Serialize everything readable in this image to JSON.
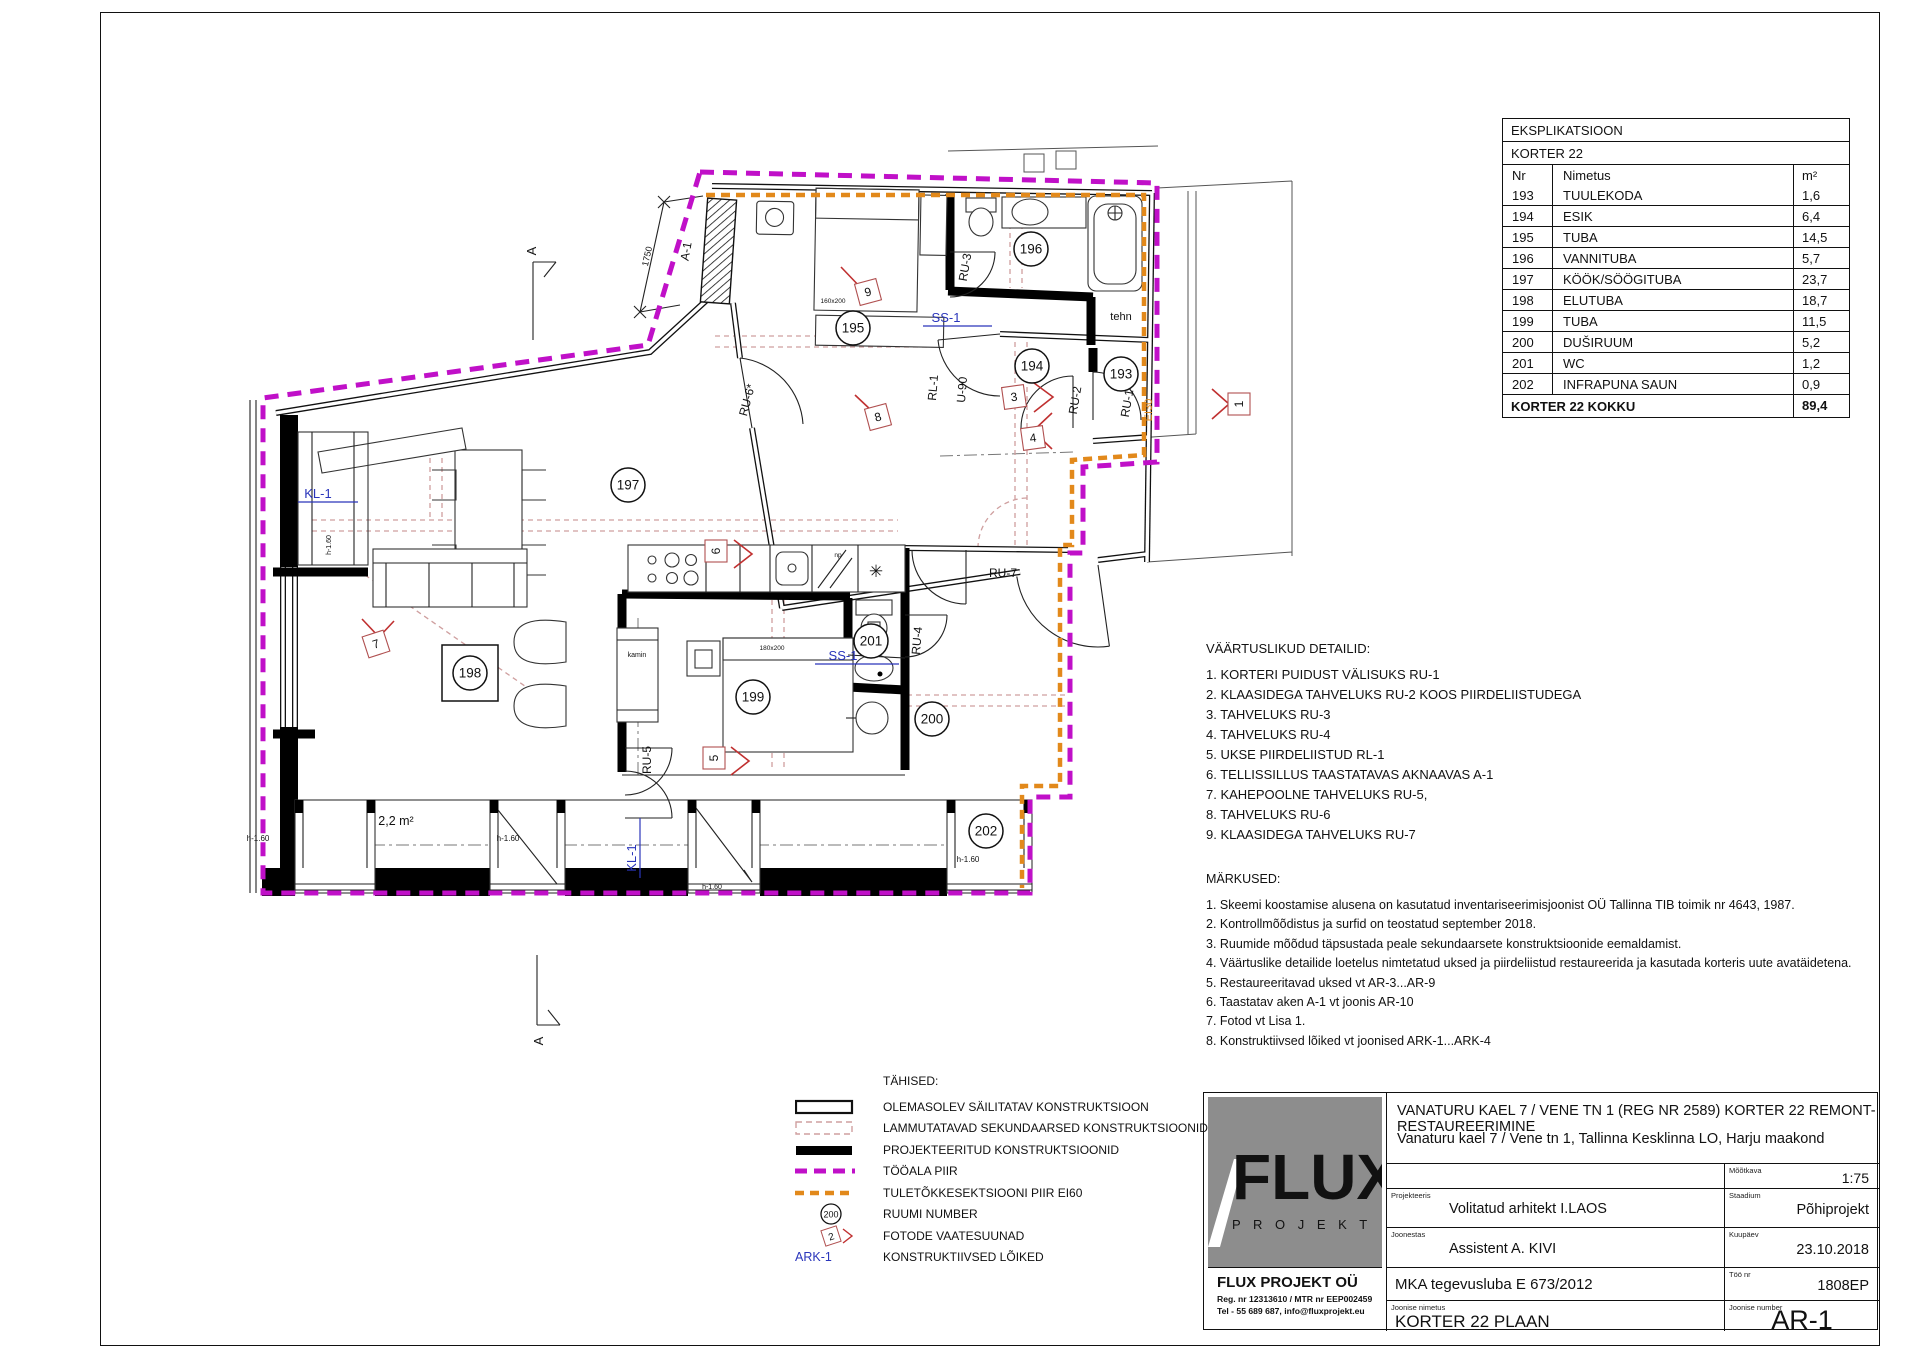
{
  "colors": {
    "work_area_boundary": "#c010c8",
    "fire_boundary": "#e2891b",
    "callout_blue": "#2a35bb",
    "marker_red": "#c03030",
    "demolition_pink": "#cf9f9f",
    "logo_gray": "#8d8d8d"
  },
  "explication": {
    "title": "EKSPLIKATSIOON",
    "subtitle": "KORTER 22",
    "columns": [
      "Nr",
      "Nimetus",
      "m²"
    ],
    "rows": [
      [
        "193",
        "TUULEKODA",
        "1,6"
      ],
      [
        "194",
        "ESIK",
        "6,4"
      ],
      [
        "195",
        "TUBA",
        "14,5"
      ],
      [
        "196",
        "VANNITUBA",
        "5,7"
      ],
      [
        "197",
        "KÖÖK/SÖÖGITUBA",
        "23,7"
      ],
      [
        "198",
        "ELUTUBA",
        "18,7"
      ],
      [
        "199",
        "TUBA",
        "11,5"
      ],
      [
        "200",
        "DUŠIRUUM",
        "5,2"
      ],
      [
        "201",
        "WC",
        "1,2"
      ],
      [
        "202",
        "INFRAPUNA SAUN",
        "0,9"
      ]
    ],
    "total_label": "KORTER 22 KOKKU",
    "total_value": "89,4"
  },
  "valuable_details": {
    "heading": "VÄÄRTUSLIKUD DETAILID:",
    "items": [
      "1. KORTERI PUIDUST VÄLISUKS RU-1",
      "2. KLAASIDEGA TAHVELUKS RU-2 KOOS PIIRDELIISTUDEGA",
      "3. TAHVELUKS RU-3",
      "4. TAHVELUKS RU-4",
      "5. UKSE PIIRDELIISTUD RL-1",
      "6. TELLISSILLUS TAASTATAVAS AKNAAVAS A-1",
      "7. KAHEPOOLNE TAHVELUKS RU-5,",
      "8. TAHVELUKS RU-6",
      "9. KLAASIDEGA TAHVELUKS RU-7"
    ]
  },
  "notes": {
    "heading": "MÄRKUSED:",
    "items": [
      "1. Skeemi koostamise alusena on kasutatud inventariseerimisjoonist OÜ Tallinna TIB toimik nr 4643, 1987.",
      "2. Kontrollmõõdistus ja surfid on teostatud september 2018.",
      "3. Ruumide mõõdud täpsustada peale sekundaarsete konstruktsioonide eemaldamist.",
      "4. Väärtuslike detailide loetelus nimtetatud uksed ja piirdeliistud restaureerida ja kasutada korteris uute avatäidetena.",
      "5. Restaureeritavad uksed vt AR-3...AR-9",
      "6. Taastatav aken A-1 vt joonis AR-10",
      "7. Fotod vt Lisa 1.",
      "8. Konstruktiivsed lõiked vt joonised ARK-1...ARK-4"
    ]
  },
  "legend": {
    "heading": "TÄHISED:",
    "items": [
      {
        "type": "existing-wall",
        "label": "OLEMASOLEV SÄILITATAV KONSTRUKTSIOON"
      },
      {
        "type": "demolish",
        "label": "LAMMUTATAVAD SEKUNDAARSED KONSTRUKTSIOONID"
      },
      {
        "type": "new-wall",
        "label": "PROJEKTEERITUD KONSTRUKTSIOONID"
      },
      {
        "type": "work-boundary",
        "label": "TÖÖALA PIIR"
      },
      {
        "type": "fire-boundary",
        "label": "TULETÕKKESEKTSIOONI PIIR EI60"
      },
      {
        "type": "room-number",
        "label": "RUUMI NUMBER",
        "swatch_text": "200"
      },
      {
        "type": "photo-direction",
        "label": "FOTODE VAATESUUNAD",
        "swatch_text": "2"
      },
      {
        "type": "section",
        "label": "KONSTRUKTIIVSED LÕIKED",
        "swatch_text": "ARK-1"
      }
    ]
  },
  "title_block": {
    "project_line1": "VANATURU KAEL 7 / VENE TN 1 (REG NR 2589) KORTER 22 REMONT-RESTAUREERIMINE",
    "project_line2": "Vanaturu kael 7 / Vene tn 1, Tallinna Kesklinna LO, Harju maakond",
    "scale_label": "Mõõtkava",
    "scale_value": "1:75",
    "designer_label": "Projekteeris",
    "designer_value": "Volitatud arhitekt I.LAOS",
    "stage_label": "Staadium",
    "stage_value": "Põhiprojekt",
    "drafter_label": "Joonestas",
    "drafter_value": "Assistent A. KIVI",
    "date_label": "Kuupäev",
    "date_value": "23.10.2018",
    "permit_value": "MKA tegevusluba E 673/2012",
    "worknr_label": "Töö nr",
    "worknr_value": "1808EP",
    "drawing_name_label": "Joonise nimetus",
    "drawing_name_value": "KORTER 22 PLAAN",
    "drawing_nr_label": "Joonise number",
    "drawing_nr_value": "AR-1",
    "logo_main": "FLUX",
    "logo_sub": "P R O J E K T",
    "company_name": "FLUX PROJEKT OÜ",
    "company_reg": "Reg. nr 12313610 / MTR nr EEP002459",
    "company_tel": "Tel - 55 689 687, info@fluxprojekt.eu"
  },
  "plan": {
    "room_markers": [
      {
        "n": "193",
        "x": 1121,
        "y": 374
      },
      {
        "n": "194",
        "x": 1032,
        "y": 366
      },
      {
        "n": "195",
        "x": 853,
        "y": 328
      },
      {
        "n": "196",
        "x": 1031,
        "y": 249
      },
      {
        "n": "197",
        "x": 628,
        "y": 485
      },
      {
        "n": "198",
        "x": 470,
        "y": 673,
        "boxed": true
      },
      {
        "n": "199",
        "x": 753,
        "y": 697
      },
      {
        "n": "200",
        "x": 932,
        "y": 719
      },
      {
        "n": "201",
        "x": 871,
        "y": 641
      },
      {
        "n": "202",
        "x": 986,
        "y": 831
      }
    ],
    "labels": [
      {
        "t": "A-1",
        "x": 690,
        "y": 252,
        "r": -80,
        "s": 12
      },
      {
        "t": "1750",
        "x": 650,
        "y": 257,
        "r": -77,
        "s": 9
      },
      {
        "t": "KL-1",
        "x": 318,
        "y": 498,
        "s": 13,
        "c": "b",
        "u": 40
      },
      {
        "t": "KL-1",
        "x": 636,
        "y": 858,
        "r": -90,
        "s": 13,
        "c": "b",
        "u": 40
      },
      {
        "t": "SS-1",
        "x": 946,
        "y": 322,
        "s": 13,
        "c": "b",
        "u": 46
      },
      {
        "t": "SS-1",
        "x": 843,
        "y": 660,
        "s": 13,
        "c": "b",
        "u": 56
      },
      {
        "t": "RU-3",
        "x": 969,
        "y": 268,
        "r": -80,
        "s": 12
      },
      {
        "t": "RL-1",
        "x": 937,
        "y": 388,
        "r": -85,
        "s": 12
      },
      {
        "t": "U-90",
        "x": 966,
        "y": 390,
        "r": -85,
        "s": 12
      },
      {
        "t": "RU-2",
        "x": 1079,
        "y": 401,
        "r": -80,
        "s": 12
      },
      {
        "t": "RU-1",
        "x": 1131,
        "y": 404,
        "r": -80,
        "s": 12
      },
      {
        "t": "RU-6*",
        "x": 751,
        "y": 401,
        "r": -75,
        "s": 12
      },
      {
        "t": "RU-5",
        "x": 651,
        "y": 760,
        "r": -90,
        "s": 12
      },
      {
        "t": "RU-4",
        "x": 921,
        "y": 641,
        "r": -85,
        "s": 12
      },
      {
        "t": "RU-7",
        "x": 1003,
        "y": 577,
        "s": 12
      },
      {
        "t": "tehn",
        "x": 1121,
        "y": 320,
        "s": 11
      },
      {
        "t": "kamin",
        "x": 637,
        "y": 657,
        "s": 7
      },
      {
        "t": "np",
        "x": 838,
        "y": 557,
        "s": 6.5
      },
      {
        "t": "✳",
        "x": 876,
        "y": 577,
        "s": 17
      },
      {
        "t": "160x200",
        "x": 833,
        "y": 303,
        "s": 6.5
      },
      {
        "t": "180x200",
        "x": 772,
        "y": 650,
        "s": 6.5
      },
      {
        "t": "2,2 m²",
        "x": 396,
        "y": 825,
        "s": 12.5
      },
      {
        "t": "h-1.60",
        "x": 258,
        "y": 841,
        "s": 8
      },
      {
        "t": "h-1.60",
        "x": 508,
        "y": 841,
        "s": 8
      },
      {
        "t": "h-1.60",
        "x": 968,
        "y": 862,
        "s": 8
      },
      {
        "t": "h-1.60",
        "x": 712,
        "y": 889,
        "s": 7
      },
      {
        "t": "h-1.60",
        "x": 331,
        "y": 545,
        "r": -90,
        "s": 7
      },
      {
        "t": "EI30",
        "x": 1152,
        "y": 410,
        "r": -90,
        "s": 11,
        "c": "o"
      },
      {
        "t": "A",
        "x": 536,
        "y": 251,
        "r": -90,
        "s": 13
      },
      {
        "t": "A",
        "x": 543,
        "y": 1041,
        "r": -90,
        "s": 13
      }
    ],
    "photo_markers": [
      {
        "n": "1",
        "x": 1239,
        "y": 404,
        "r": -90
      },
      {
        "n": "3",
        "x": 1014,
        "y": 397,
        "r": -8
      },
      {
        "n": "4",
        "x": 1033,
        "y": 438,
        "r": -8
      },
      {
        "n": "5",
        "x": 714,
        "y": 758,
        "r": -90
      },
      {
        "n": "6",
        "x": 716,
        "y": 551,
        "r": -90
      },
      {
        "n": "7",
        "x": 376,
        "y": 644,
        "r": -18
      },
      {
        "n": "8",
        "x": 878,
        "y": 417,
        "r": -15
      },
      {
        "n": "9",
        "x": 868,
        "y": 292,
        "r": -15
      }
    ]
  }
}
